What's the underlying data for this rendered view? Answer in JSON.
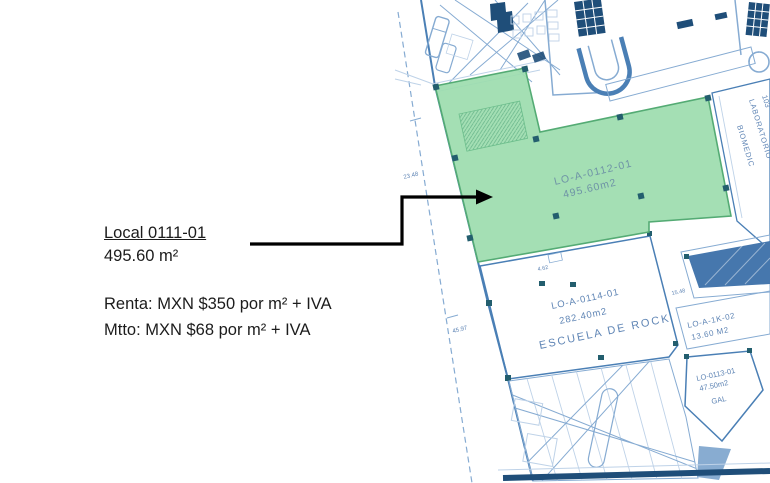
{
  "annotation": {
    "title": "Local 0111-01",
    "area": "495.60 m²",
    "renta": "Renta: MXN $350 por m² + IVA",
    "mtto": "Mtto: MXN $68 por m² + IVA"
  },
  "plan": {
    "highlight": {
      "id": "LO-A-0112-01",
      "area": "495.60m2"
    },
    "escuela": {
      "id": "LO-A-0114-01",
      "area": "282.40m2",
      "name": "ESCUELA DE ROCK"
    },
    "kiosk": {
      "id": "LO-A-1K-02",
      "area": "13.60 M2"
    },
    "unit0113": {
      "id": "LO-0113-01",
      "area": "47.50m2",
      "name": "GAL"
    },
    "lab": {
      "number": "103",
      "line1": "LABORATORIO",
      "line2": "BIOMEDIC"
    },
    "dims": {
      "d1": "23.48",
      "d2": "45.97",
      "d3": "4.62",
      "d4": "15.48"
    }
  },
  "colors": {
    "highlight-fill": "#9cdcae",
    "highlight-stroke": "#54ab74",
    "highlight-text": "#6f94a6",
    "line-light": "#bed2e8",
    "line-mid": "#86abd2",
    "line-strong": "#4a7fb5",
    "navy": "#1f4e79",
    "steel": "#4677ad",
    "marker": "#235e6e",
    "plan-text": "#5f85b5",
    "annotation-text": "#1c1c1c",
    "arrow": "#000000"
  }
}
